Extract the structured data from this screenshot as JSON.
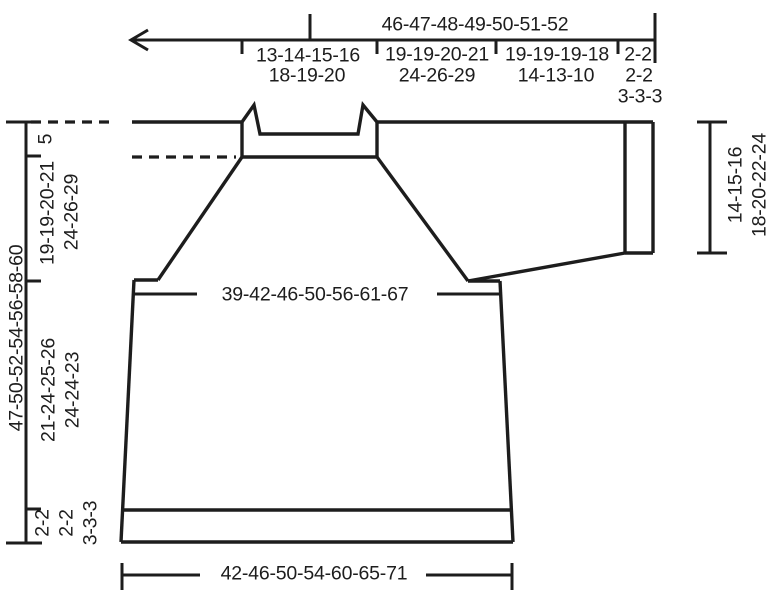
{
  "diagram": {
    "top_ruler": {
      "total_width": "46-47-48-49-50-51-52",
      "segments": [
        {
          "lines": [
            "13-14-15-16",
            "18-19-20"
          ]
        },
        {
          "lines": [
            "19-19-20-21",
            "24-26-29"
          ]
        },
        {
          "lines": [
            "19-19-19-18",
            "14-13-10"
          ]
        },
        {
          "lines": [
            "2-2",
            "2-2",
            "3-3-3"
          ]
        }
      ]
    },
    "left_ruler": {
      "neck_depth": "5",
      "yoke_depth": {
        "lines": [
          "19-19-20-21",
          "24-26-29"
        ]
      },
      "total_length": "47-50-52-54-56-58-60",
      "body_length": {
        "lines": [
          "21-24-25-26",
          "24-24-23"
        ]
      },
      "ribbing": {
        "lines": [
          "2-2",
          "2-2",
          "3-3-3"
        ]
      }
    },
    "right_ruler": {
      "sleeve_length": {
        "lines": [
          "14-15-16",
          "18-20-22-24"
        ]
      }
    },
    "chest_width": "39-42-46-50-56-61-67",
    "hem_width": "42-46-50-54-60-65-71",
    "colors": {
      "line": "#1d1d1d",
      "background": "#ffffff"
    }
  }
}
